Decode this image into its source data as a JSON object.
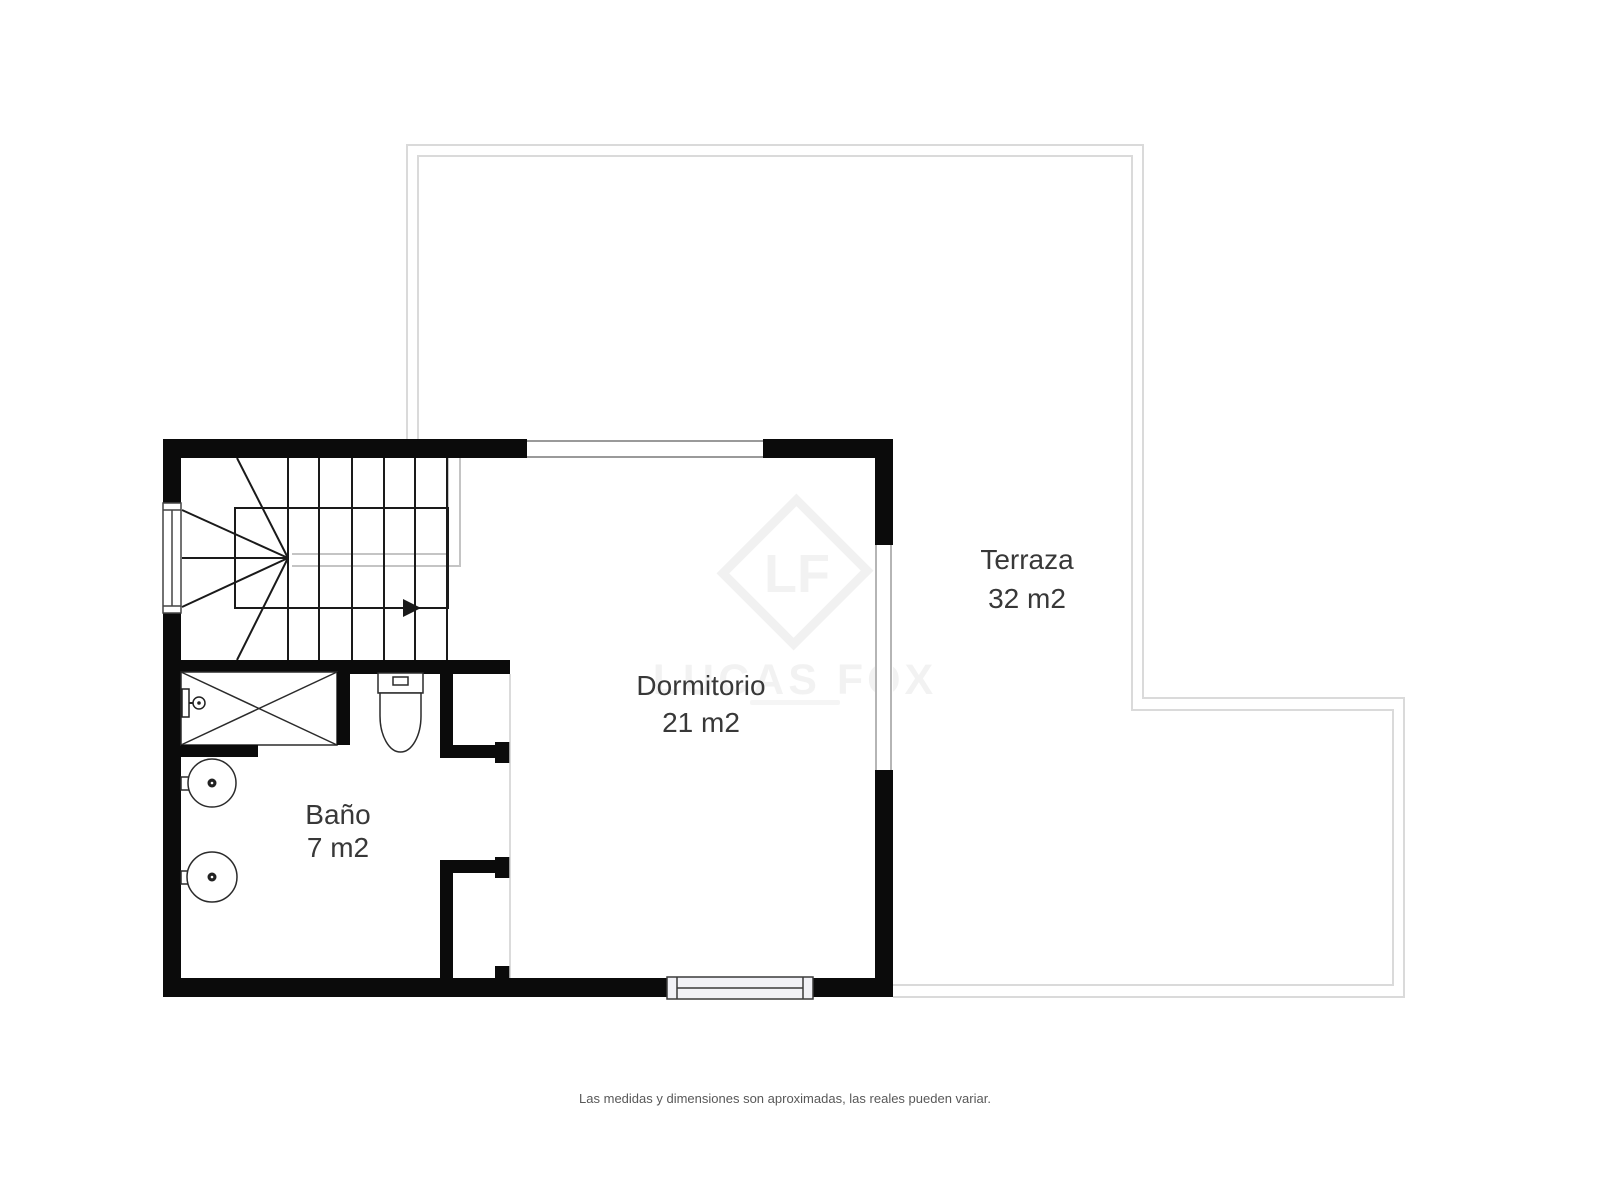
{
  "page": {
    "footer_disclaimer": "Las medidas y dimensiones son aproximadas, las reales pueden variar."
  },
  "watermark": {
    "initials": "LF",
    "brand": "LUCAS FOX"
  },
  "rooms": {
    "terraza": {
      "name": "Terraza",
      "area": "32 m2"
    },
    "dormitorio": {
      "name": "Dormitorio",
      "area": "21 m2"
    },
    "bano": {
      "name": "Baño",
      "area": "7 m2"
    }
  },
  "colors": {
    "wall": "#0b0b0b",
    "label_text": "#383838",
    "terrace_outline": "#dadada",
    "stair_break_line": "#c4c4c4",
    "window_frame": "#8f8f8f",
    "footer_text": "#585858",
    "background": "#ffffff"
  }
}
